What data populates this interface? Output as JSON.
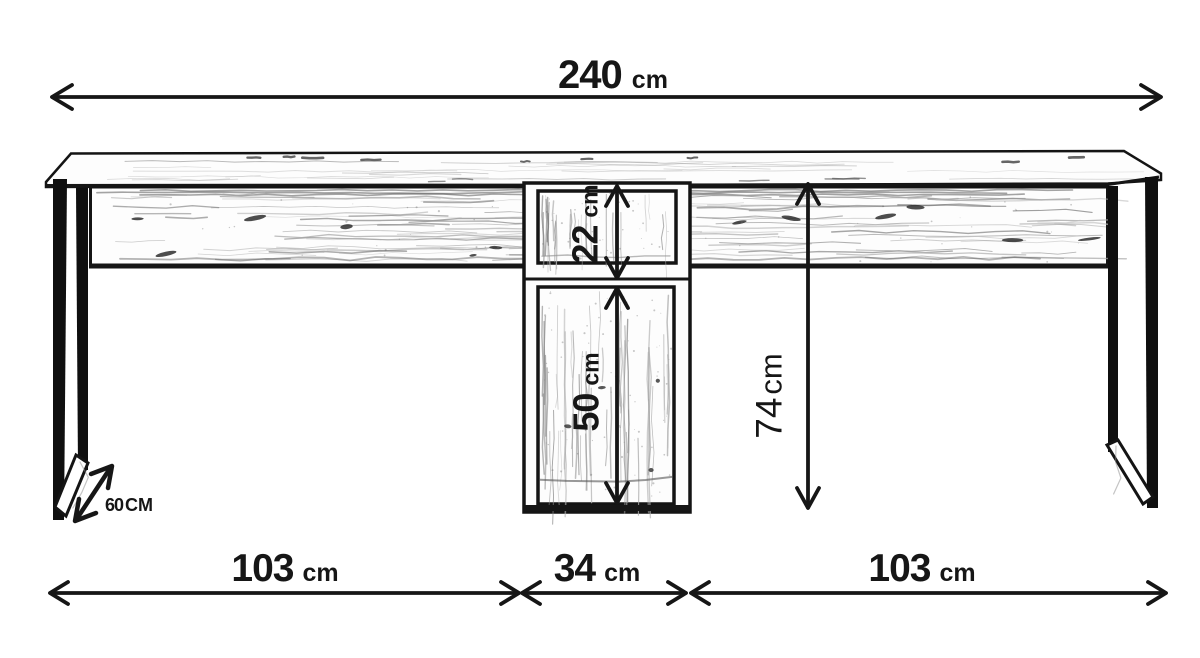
{
  "dims": {
    "total_width": {
      "value": "240",
      "unit": "cm"
    },
    "left_section": {
      "value": "103",
      "unit": "cm"
    },
    "center_section": {
      "value": "34",
      "unit": "cm"
    },
    "right_section": {
      "value": "103",
      "unit": "cm"
    },
    "upper_shelf": {
      "value": "22",
      "unit": "cm"
    },
    "lower_cabinet": {
      "value": "50",
      "unit": "cm"
    },
    "height": {
      "value": "74",
      "unit": "cm"
    },
    "depth": {
      "value": "60",
      "unit": "CM"
    }
  },
  "colors": {
    "ink": "#161616",
    "background": "#ffffff",
    "wood_grain": "#9a9a9a",
    "knot": "#2e2e2e"
  }
}
